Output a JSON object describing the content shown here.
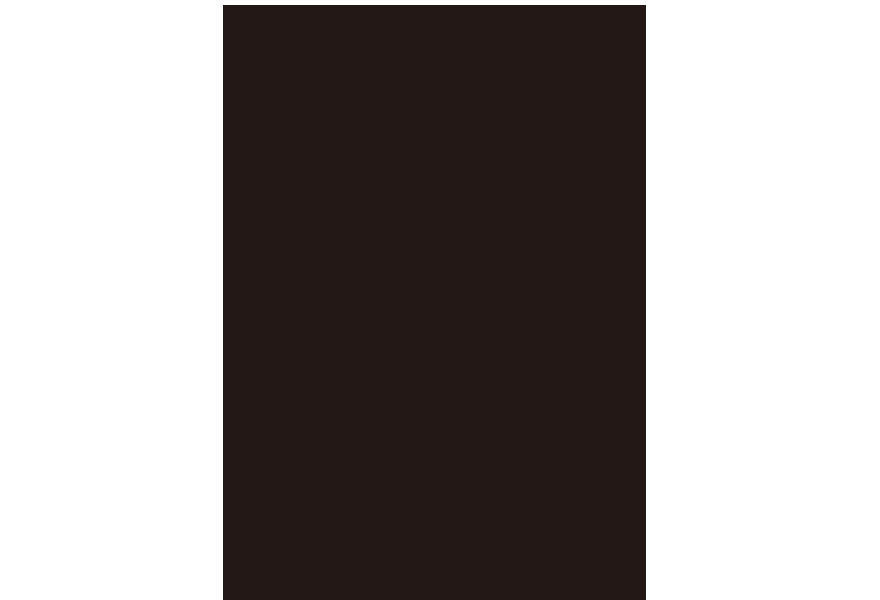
{
  "viewer": {
    "background_color": "#ffffff"
  },
  "page": {
    "description": "entirely dark blank page, no visible text or graphics",
    "fill_color": "#231815",
    "text_content": ""
  }
}
